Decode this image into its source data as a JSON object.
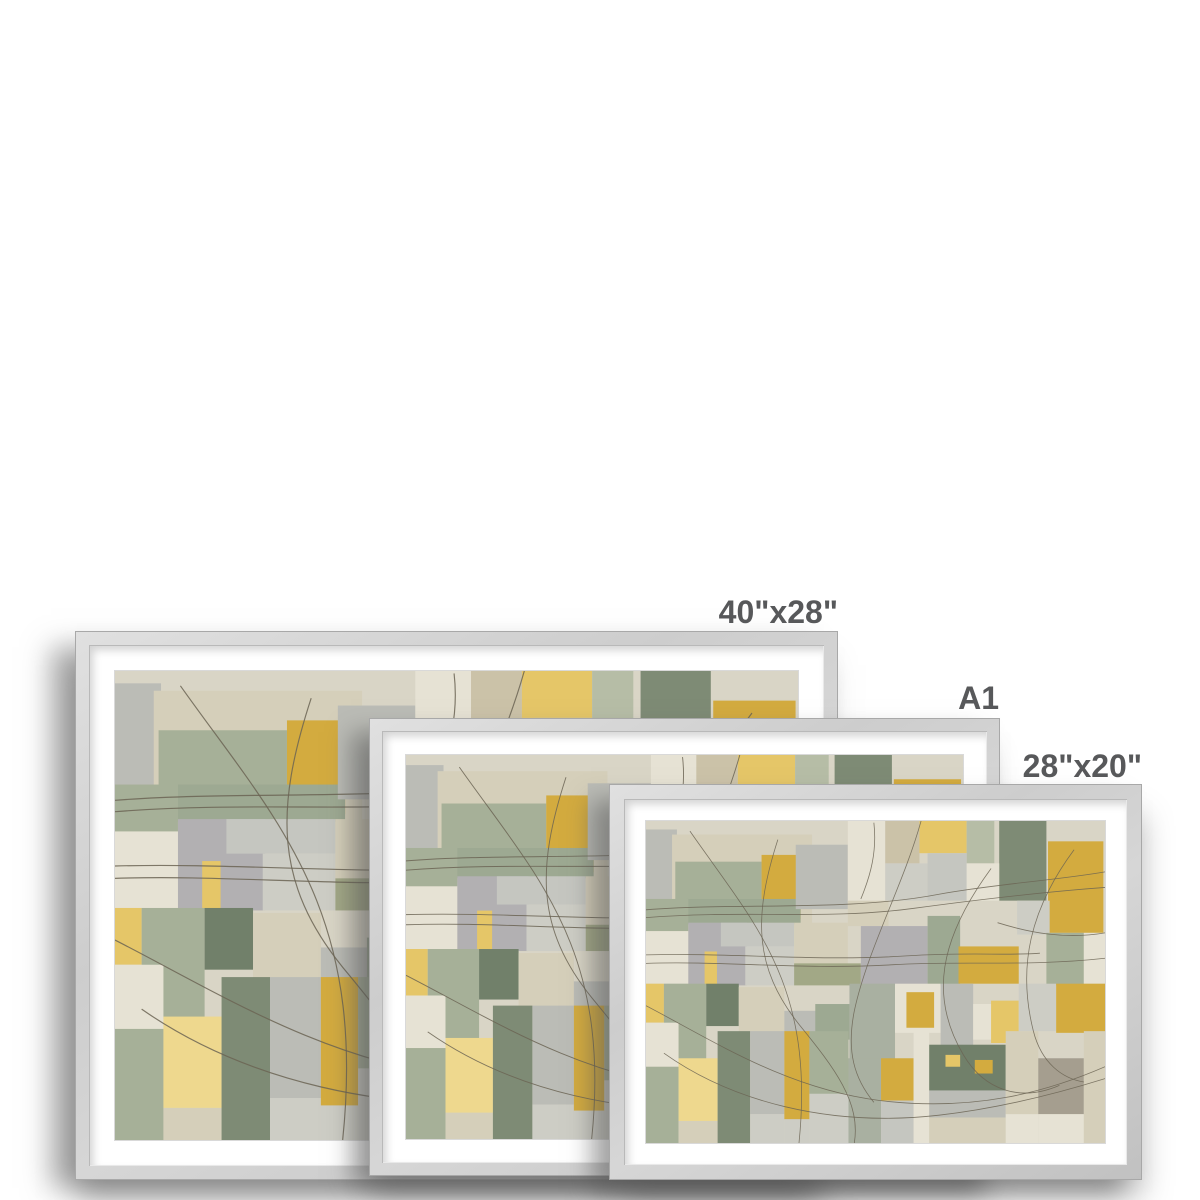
{
  "page": {
    "background": "#ffffff",
    "type_note": "framed print size comparison preview"
  },
  "sizes": [
    {
      "label": "40\"x28\""
    },
    {
      "label": "A1"
    },
    {
      "label": "28\"x20\""
    }
  ],
  "colors": {
    "page_background": "#ffffff",
    "frame_face": "#cdcdcd",
    "frame_edge": "#a8a8a8",
    "mat": "#ffffff",
    "label_text": "#57585a",
    "shadow": "rgba(85,85,85,0.5)"
  },
  "artwork": {
    "viewbox": [
      1410,
      950
    ],
    "line_color": "#6b6454",
    "line_width": 2.4,
    "palette": {
      "bg": "#d9d5c6",
      "offWhite": "#e6e2d4",
      "cream": "#e2ddcb",
      "beige": "#d5cfba",
      "tan": "#cbc2a8",
      "paleGrey": "#cdcdc5",
      "lightGrey": "#c5c6c0",
      "grey": "#bbbcb6",
      "coolGrey": "#b2b0b2",
      "greyBrown": "#a59e8f",
      "sage": "#a6b098",
      "sageLight": "#b6bda6",
      "sageGrey": "#9da992",
      "greyGreen": "#a9b0a1",
      "olive": "#a2a886",
      "darkSage": "#7e8b75",
      "darkGreen": "#71806a",
      "gold": "#d3ab3f",
      "goldLight": "#e5c668",
      "goldBright": "#eed88e"
    },
    "patches": [
      [
        0,
        25,
        95,
        290,
        "grey"
      ],
      [
        80,
        40,
        430,
        275,
        "beige"
      ],
      [
        90,
        120,
        265,
        115,
        "sage"
      ],
      [
        355,
        100,
        120,
        190,
        "gold"
      ],
      [
        125,
        230,
        350,
        75,
        "sageGrey"
      ],
      [
        460,
        70,
        160,
        190,
        "grey"
      ],
      [
        620,
        0,
        115,
        240,
        "offWhite"
      ],
      [
        735,
        0,
        105,
        125,
        "tan"
      ],
      [
        840,
        0,
        145,
        95,
        "goldLight"
      ],
      [
        985,
        0,
        85,
        125,
        "sageLight"
      ],
      [
        1085,
        0,
        145,
        235,
        "darkSage"
      ],
      [
        1235,
        60,
        170,
        270,
        "gold"
      ],
      [
        735,
        125,
        130,
        110,
        "paleGrey"
      ],
      [
        865,
        95,
        120,
        140,
        "lightGrey"
      ],
      [
        985,
        125,
        100,
        110,
        "offWhite"
      ],
      [
        0,
        230,
        130,
        95,
        "sage"
      ],
      [
        0,
        325,
        130,
        155,
        "offWhite"
      ],
      [
        130,
        300,
        180,
        185,
        "coolGrey"
      ],
      [
        230,
        300,
        225,
        70,
        "lightGrey"
      ],
      [
        305,
        370,
        150,
        115,
        "paleGrey"
      ],
      [
        180,
        385,
        38,
        100,
        "goldLight"
      ],
      [
        455,
        300,
        165,
        125,
        "beige"
      ],
      [
        455,
        420,
        205,
        65,
        "olive"
      ],
      [
        620,
        235,
        125,
        75,
        "beige"
      ],
      [
        660,
        310,
        205,
        175,
        "coolGrey"
      ],
      [
        865,
        280,
        100,
        205,
        "sageGrey"
      ],
      [
        960,
        370,
        185,
        110,
        "gold"
      ],
      [
        1140,
        235,
        100,
        100,
        "paleGrey"
      ],
      [
        1230,
        330,
        115,
        155,
        "sage"
      ],
      [
        1345,
        330,
        65,
        150,
        "offWhite"
      ],
      [
        0,
        480,
        55,
        115,
        "goldLight"
      ],
      [
        55,
        480,
        130,
        225,
        "sage"
      ],
      [
        185,
        480,
        100,
        125,
        "darkGreen"
      ],
      [
        285,
        490,
        140,
        135,
        "beige"
      ],
      [
        425,
        560,
        100,
        145,
        "grey"
      ],
      [
        520,
        540,
        105,
        105,
        "sageGrey"
      ],
      [
        625,
        480,
        140,
        225,
        "greyGreen"
      ],
      [
        765,
        480,
        140,
        145,
        "offWhite"
      ],
      [
        800,
        505,
        85,
        105,
        "gold"
      ],
      [
        905,
        480,
        100,
        225,
        "grey"
      ],
      [
        1005,
        540,
        100,
        105,
        "offWhite"
      ],
      [
        1060,
        530,
        85,
        125,
        "goldLight"
      ],
      [
        1145,
        480,
        115,
        140,
        "paleGrey"
      ],
      [
        1260,
        480,
        150,
        145,
        "gold"
      ],
      [
        0,
        595,
        100,
        130,
        "offWhite"
      ],
      [
        0,
        725,
        100,
        225,
        "sage"
      ],
      [
        100,
        700,
        120,
        185,
        "goldBright"
      ],
      [
        100,
        885,
        120,
        65,
        "beige"
      ],
      [
        220,
        620,
        100,
        330,
        "darkSage"
      ],
      [
        320,
        620,
        105,
        245,
        "grey"
      ],
      [
        320,
        865,
        105,
        85,
        "paleGrey"
      ],
      [
        425,
        620,
        77,
        260,
        "gold"
      ],
      [
        425,
        880,
        77,
        70,
        "paleGrey"
      ],
      [
        502,
        620,
        120,
        185,
        "sage"
      ],
      [
        502,
        805,
        120,
        145,
        "paleGrey"
      ],
      [
        622,
        700,
        100,
        250,
        "greyGreen"
      ],
      [
        722,
        700,
        100,
        125,
        "gold"
      ],
      [
        722,
        825,
        100,
        125,
        "lightGrey"
      ],
      [
        822,
        620,
        48,
        330,
        "offWhite"
      ],
      [
        870,
        660,
        235,
        135,
        "darkGreen"
      ],
      [
        920,
        690,
        45,
        35,
        "goldLight"
      ],
      [
        1010,
        705,
        55,
        40,
        "gold"
      ],
      [
        870,
        795,
        235,
        80,
        "grey"
      ],
      [
        870,
        875,
        235,
        75,
        "beige"
      ],
      [
        1105,
        620,
        100,
        245,
        "beige"
      ],
      [
        1105,
        865,
        100,
        85,
        "offWhite"
      ],
      [
        1205,
        700,
        140,
        165,
        "greyBrown"
      ],
      [
        1205,
        865,
        140,
        85,
        "offWhite"
      ],
      [
        1345,
        620,
        65,
        330,
        "beige"
      ]
    ],
    "lines": [
      "M0,262 C280,240 620,268 900,216 C1080,185 1260,175 1410,150",
      "M0,285 C300,262 560,292 820,258 C1020,232 1240,208 1410,196",
      "M0,395 C260,388 520,415 800,398 C1000,386 1100,398 1210,390",
      "M0,420 C240,412 480,440 760,424 C960,412 1180,430 1410,405",
      "M135,30 C330,300 520,480 470,950",
      "M405,55 C330,280 330,430 470,600 C580,730 660,830 640,950",
      "M845,0 C790,190 680,380 640,560 C615,680 640,760 700,830",
      "M1060,140 C900,350 870,520 975,690 C1040,795 1150,830 1270,780",
      "M1315,85 C1180,260 1140,430 1190,620 C1215,715 1280,760 1345,770",
      "M0,545 C210,650 430,790 720,825 C1010,858 1230,800 1410,725",
      "M55,685 C260,825 560,905 900,868 C1080,848 1260,805 1410,760",
      "M1410,330 C1290,350 1180,330 1080,300",
      "M700,5 C710,90 690,160 660,230"
    ]
  }
}
